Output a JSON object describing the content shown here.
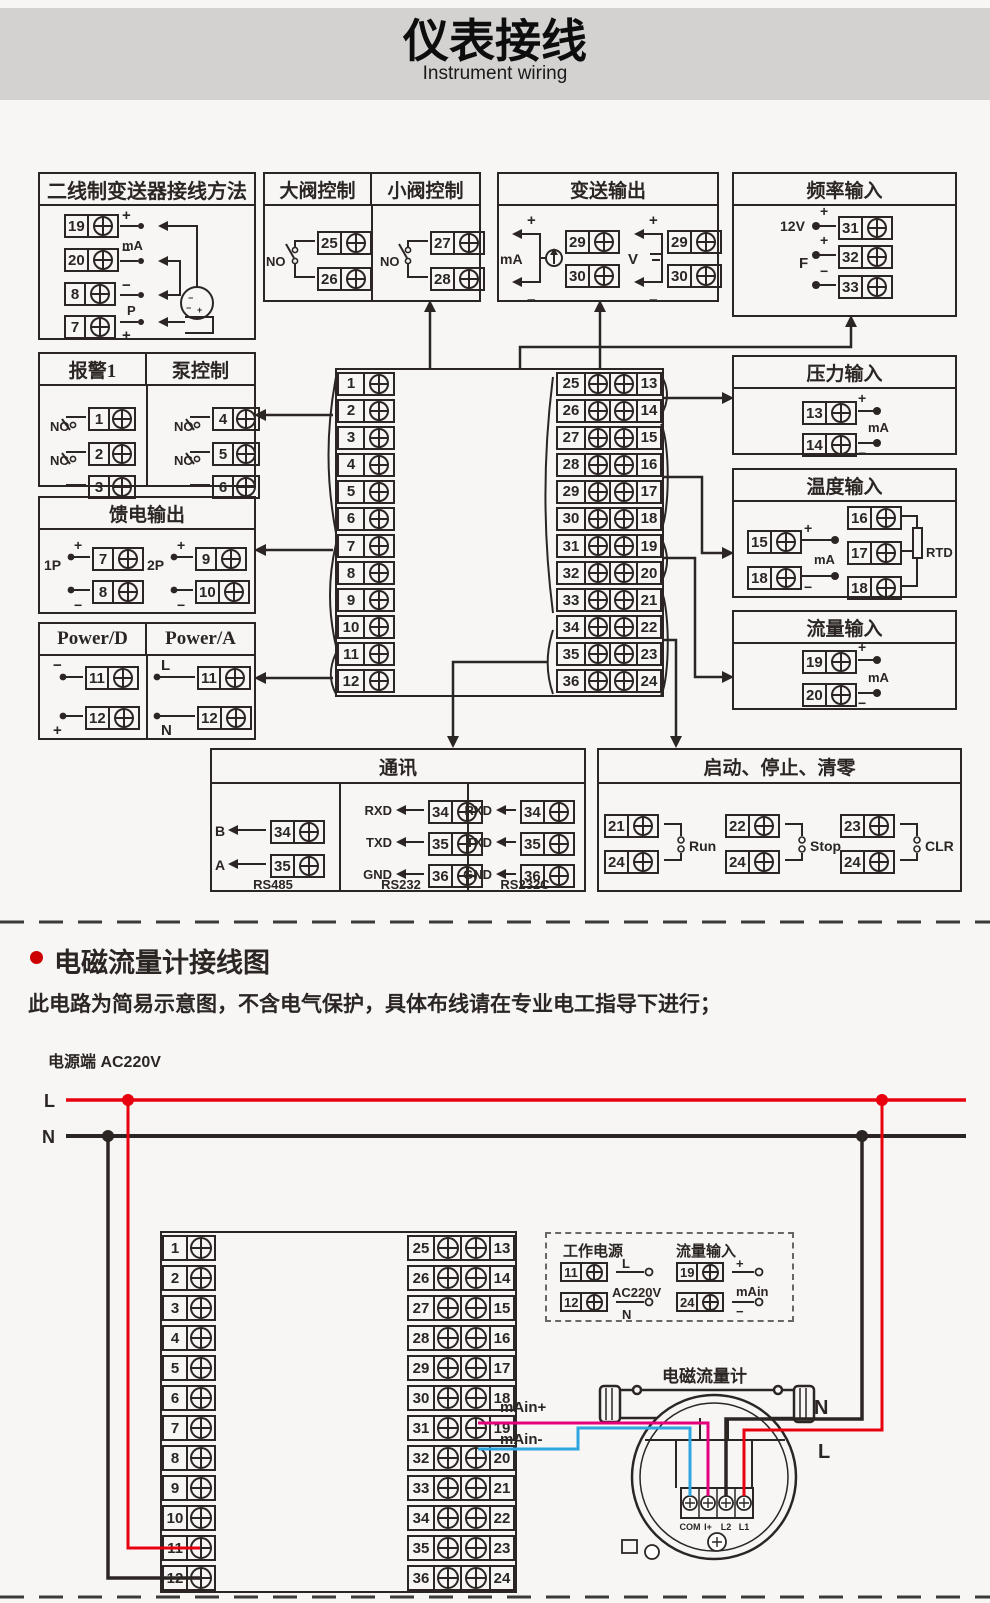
{
  "page": {
    "title": "仪表接线",
    "subtitle": "Instrument wiring"
  },
  "colors": {
    "banner": "#d3d2d1",
    "line": "#2b2623",
    "red": "#e8000e",
    "blue": "#2ea7e0",
    "magenta": "#e5007e",
    "bullet": "#cc0000"
  },
  "labels": {
    "plus": "+",
    "minus": "−",
    "ma": "mA",
    "p": "P",
    "no": "NO",
    "nc": "NC",
    "v12": "12V",
    "f": "F",
    "p1": "1P",
    "p2": "2P",
    "l": "L",
    "n": "N",
    "v": "V",
    "rtd": "RTD",
    "b": "B",
    "a": "A",
    "rxd": "RXD",
    "txd": "TXD",
    "gnd": "GND",
    "rs485": "RS485",
    "rs232": "RS232",
    "rs232c": "RS232C",
    "run": "Run",
    "stop": "Stop",
    "clr": "CLR",
    "main": "mAin",
    "main_plus": "mAin+",
    "main_minus": "mAin-",
    "ac220": "AC220V",
    "com": "COM",
    "i_plus": "I+",
    "l2": "L2",
    "l1": "L1"
  },
  "boxes": {
    "two_wire": {
      "title": "二线制变送器接线方法",
      "t": [
        "19",
        "20",
        "8",
        "7"
      ]
    },
    "big_valve": {
      "title": "大阀控制",
      "t": [
        "25",
        "26"
      ]
    },
    "small_valve": {
      "title": "小阀控制",
      "t": [
        "27",
        "28"
      ]
    },
    "transmit": {
      "title": "变送输出",
      "t_ma": [
        "29",
        "30"
      ],
      "t_v": [
        "29",
        "30"
      ]
    },
    "freq": {
      "title": "频率输入",
      "t": [
        "31",
        "32",
        "33"
      ]
    },
    "alarm": {
      "title": "报警1",
      "t": [
        "1",
        "2",
        "3"
      ]
    },
    "pump": {
      "title": "泵控制",
      "t": [
        "4",
        "5",
        "6"
      ]
    },
    "feed": {
      "title": "馈电输出",
      "t1": [
        "7",
        "8"
      ],
      "t2": [
        "9",
        "10"
      ]
    },
    "power_d": {
      "title": "Power/D",
      "t": [
        "11",
        "12"
      ]
    },
    "power_a": {
      "title": "Power/A",
      "t": [
        "11",
        "12"
      ]
    },
    "pressure": {
      "title": "压力输入",
      "t": [
        "13",
        "14"
      ]
    },
    "temp": {
      "title": "温度输入",
      "t_ma": [
        "15",
        "18"
      ],
      "t_rtd": [
        "16",
        "17",
        "18"
      ]
    },
    "flow": {
      "title": "流量输入",
      "t": [
        "19",
        "20"
      ]
    },
    "comm": {
      "title": "通讯",
      "rs485_t": [
        "34",
        "35"
      ],
      "rs232_t": [
        "34",
        "35",
        "36"
      ],
      "rs232c_t": [
        "34",
        "35",
        "36"
      ]
    },
    "runstop": {
      "title": "启动、停止、清零",
      "g": [
        [
          "21",
          "24"
        ],
        [
          "22",
          "24"
        ],
        [
          "23",
          "24"
        ]
      ]
    }
  },
  "strip_rows": [
    {
      "l": "1",
      "m": "25",
      "r": "13"
    },
    {
      "l": "2",
      "m": "26",
      "r": "14"
    },
    {
      "l": "3",
      "m": "27",
      "r": "15"
    },
    {
      "l": "4",
      "m": "28",
      "r": "16"
    },
    {
      "l": "5",
      "m": "29",
      "r": "17"
    },
    {
      "l": "6",
      "m": "30",
      "r": "18"
    },
    {
      "l": "7",
      "m": "31",
      "r": "19"
    },
    {
      "l": "8",
      "m": "32",
      "r": "20"
    },
    {
      "l": "9",
      "m": "33",
      "r": "21"
    },
    {
      "l": "10",
      "m": "34",
      "r": "22"
    },
    {
      "l": "11",
      "m": "35",
      "r": "23"
    },
    {
      "l": "12",
      "m": "36",
      "r": "24"
    }
  ],
  "section2": {
    "heading": "电磁流量计接线图",
    "note": "此电路为简易示意图，不含电气保护，具体布线请在专业电工指导下进行；",
    "power_label": "电源端 AC220V",
    "dashed": {
      "power_title": "工作电源",
      "power_t": [
        "11",
        "12"
      ],
      "flow_title": "流量输入",
      "flow_t": [
        "19",
        "24"
      ]
    },
    "flowmeter": {
      "title": "电磁流量计"
    }
  }
}
